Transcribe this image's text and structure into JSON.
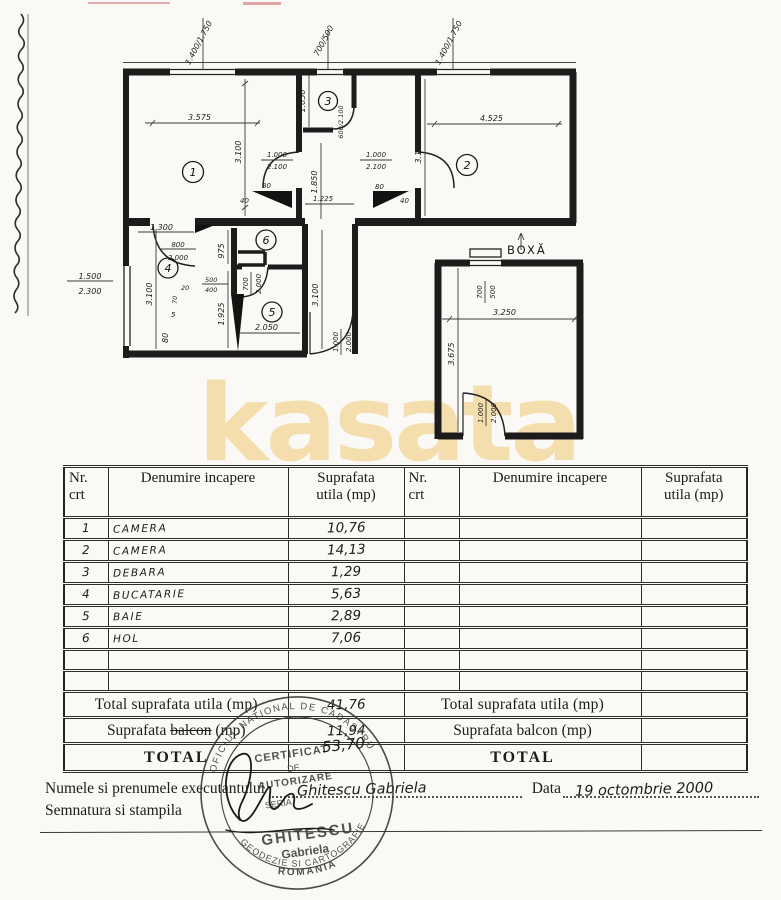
{
  "watermark": {
    "text": "kasata",
    "color": "rgba(240,205,130,0.62)"
  },
  "plan": {
    "rooms": [
      "1",
      "2",
      "3",
      "4",
      "5",
      "6"
    ],
    "boxa_label": "BOXĂ",
    "dims": {
      "win_top_left": "1.400/1.750",
      "win_top_mid": "700/500",
      "win_top_right": "1.400/1.750",
      "room1_w": "3.575",
      "room1_h": "3.100",
      "room2_w": "4.525",
      "room2_h": "3.125",
      "room3_h": "1.050",
      "hall_h": "1.850",
      "corridor_w": "1.225",
      "door_room1_a": "1.000",
      "door_room1_b": "2.100",
      "door_room2_a": "1.000",
      "door_room2_b": "2.100",
      "door_room3": "600/2.100",
      "d80_left": "80",
      "d40_left": "40",
      "d80_right": "80",
      "d40_right": "40",
      "kitchen_top": "1.300",
      "door_room4_a": "800",
      "door_room4_b": "2.000",
      "hall6_h": "975",
      "left_h": "3.100",
      "win_left_a": "1.500",
      "win_left_b": "2.300",
      "niche_a": "500",
      "niche_b": "400",
      "niche_c": "20",
      "niche_d": "70",
      "niche_e": "5",
      "niche_f": "80",
      "door_room5_a": "700",
      "door_room5_b": "2.000",
      "bath_h": "1.925",
      "bath_w": "2.050",
      "corridor_h": "3.100",
      "door_entry_a": "1.000",
      "door_entry_b": "2.000",
      "boxa_win_a": "700",
      "boxa_win_b": "500",
      "boxa_w": "3.250",
      "boxa_h": "3.675",
      "boxa_door_a": "1.000",
      "boxa_door_b": "2.000"
    }
  },
  "table": {
    "headers": {
      "nr1": "Nr.",
      "nr2": "crt",
      "name": "Denumire incapere",
      "sup1": "Suprafata",
      "sup2": "utila (mp)"
    },
    "rows": [
      {
        "nr": "1",
        "name": "CAMERA",
        "area": "10,76"
      },
      {
        "nr": "2",
        "name": "CAMERA",
        "area": "14,13"
      },
      {
        "nr": "3",
        "name": "DEBARA",
        "area": "1,29"
      },
      {
        "nr": "4",
        "name": "BUCATARIE",
        "area": "5,63"
      },
      {
        "nr": "5",
        "name": "BAIE",
        "area": "2,89"
      },
      {
        "nr": "6",
        "name": "HOL",
        "area": "7,06"
      },
      {
        "nr": "",
        "name": "",
        "area": ""
      },
      {
        "nr": "",
        "name": "",
        "area": ""
      }
    ],
    "totals": {
      "utila_label": "Total suprafata utila (mp)",
      "utila_value": "41,76",
      "balcon_label_pre": "Suprafata",
      "balcon_label_strike": "balcon",
      "balcon_label_post": "(mp)",
      "balcon_overwrite": "BOXA",
      "balcon_value": "11,94",
      "total_label": "TOTAL",
      "total_value": "53,70"
    }
  },
  "footer": {
    "name_label": "Numele si prenumele executantului",
    "name_value": "Ghitescu Gabriela",
    "date_label": "Data",
    "date_value": "19 octombrie 2000",
    "sign_label": "Semnatura si stampila"
  },
  "stamp": {
    "ring_top": "OFICIUL NATIONAL DE CADASTRU",
    "ring_bottom": "GEODEZIE SI CARTOGRAFIE",
    "line1": "CERTIFICAT",
    "line2": "DE",
    "line3": "AUTORIZARE",
    "line4": "SERIA",
    "name": "GHITESCU",
    "firstname": "Gabriela",
    "country": "ROMANIA"
  }
}
